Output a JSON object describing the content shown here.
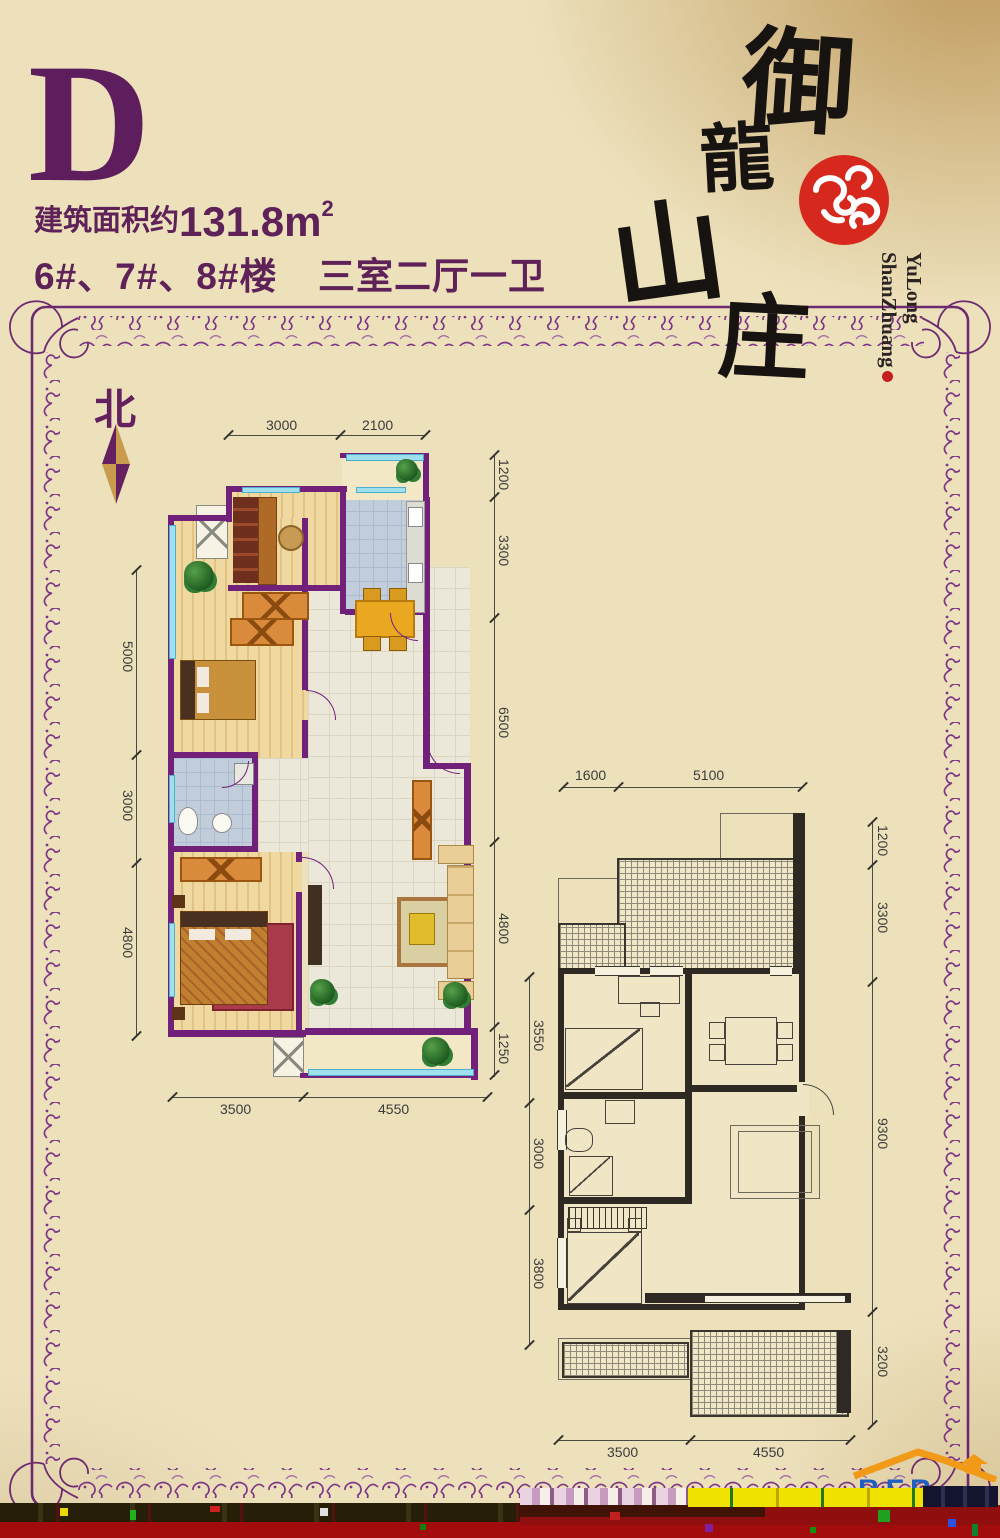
{
  "header": {
    "plan_letter": "D",
    "area_prefix": "建筑面积约",
    "area_value": "131.8m",
    "area_sup": "2",
    "buildings_text": "6#、7#、8#楼",
    "rooms_text": "三室二厅一卫"
  },
  "logo": {
    "char1": "御",
    "char2": "龍",
    "char3": "山",
    "char4": "庄",
    "roman1": "YuLong",
    "roman2": "ShanZhuang"
  },
  "compass": {
    "north_label": "北"
  },
  "plans": {
    "left": {
      "dims_top": [
        "3000",
        "2100"
      ],
      "dims_right": [
        "1200",
        "3300",
        "6500",
        "4800",
        "1250"
      ],
      "dims_left": [
        "5000",
        "3000",
        "4800"
      ],
      "dims_bottom": [
        "3500",
        "4550"
      ]
    },
    "right": {
      "dims_top": [
        "1600",
        "5100"
      ],
      "dims_right": [
        "1200",
        "3300",
        "9300",
        "3200"
      ],
      "dims_left": [
        "3550",
        "3000",
        "3800"
      ],
      "dims_bottom": [
        "3500",
        "4550"
      ]
    }
  },
  "watermark": {
    "letters": "BFB"
  },
  "colors": {
    "accent_purple": "#5E2158",
    "wall_purple": "#72217A",
    "seal_red": "#D6281C",
    "gold": "#C79A55",
    "glitch_red": "#A30C0C",
    "glitch_yellow": "#F0E200"
  }
}
